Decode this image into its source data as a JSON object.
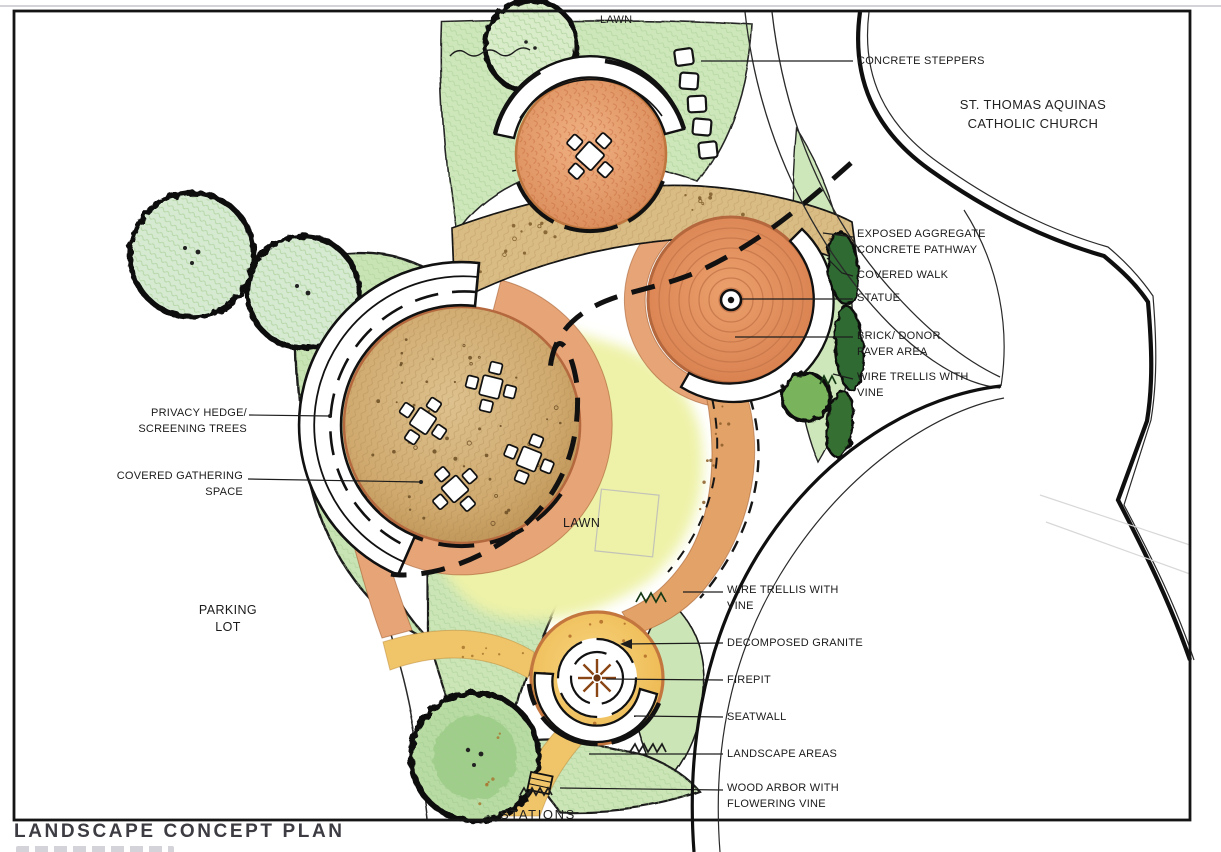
{
  "page": {
    "title": "LANDSCAPE CONCEPT PLAN"
  },
  "plan_labels": {
    "lawn_top": "LAWN",
    "lawn_center": "LAWN",
    "church_line1": "ST. THOMAS AQUINAS",
    "church_line2": "CATHOLIC CHURCH",
    "parking_line1": "PARKING",
    "parking_line2": "LOT",
    "stations": "STATIONS"
  },
  "callouts": {
    "concrete_steppers": "CONCRETE STEPPERS",
    "exposed_aggregate_line1": "EXPOSED AGGREGATE",
    "exposed_aggregate_line2": "CONCRETE PATHWAY",
    "covered_walk": "COVERED WALK",
    "statue": "STATUE",
    "brick_donor_line1": "BRICK/ DONOR",
    "brick_donor_line2": "PAVER AREA",
    "wire_trellis_top_line1": "WIRE TRELLIS WITH",
    "wire_trellis_top_line2": "VINE",
    "privacy_hedge_line1": "PRIVACY HEDGE/",
    "privacy_hedge_line2": "SCREENING TREES",
    "covered_gathering_line1": "COVERED GATHERING",
    "covered_gathering_line2": "SPACE",
    "wire_trellis_bottom_line1": "WIRE TRELLIS WITH",
    "wire_trellis_bottom_line2": "VINE",
    "decomposed_granite": "DECOMPOSED GRANITE",
    "firepit": "FIREPIT",
    "seatwall": "SEATWALL",
    "landscape_areas": "LANDSCAPE AREAS",
    "wood_arbor_line1": "WOOD ARBOR WITH",
    "wood_arbor_line2": "FLOWERING VINE"
  },
  "colors": {
    "pathway_tan": "#d9bc84",
    "plaza_orange": "#e09468",
    "paver_orange": "#e7a477",
    "granite_yellow": "#f3c869",
    "lawn_green": "#cde7ba",
    "lawn_bright": "#eef2a8",
    "shrub_dark": "#2f6b31",
    "ink": "#1b1b1b"
  }
}
